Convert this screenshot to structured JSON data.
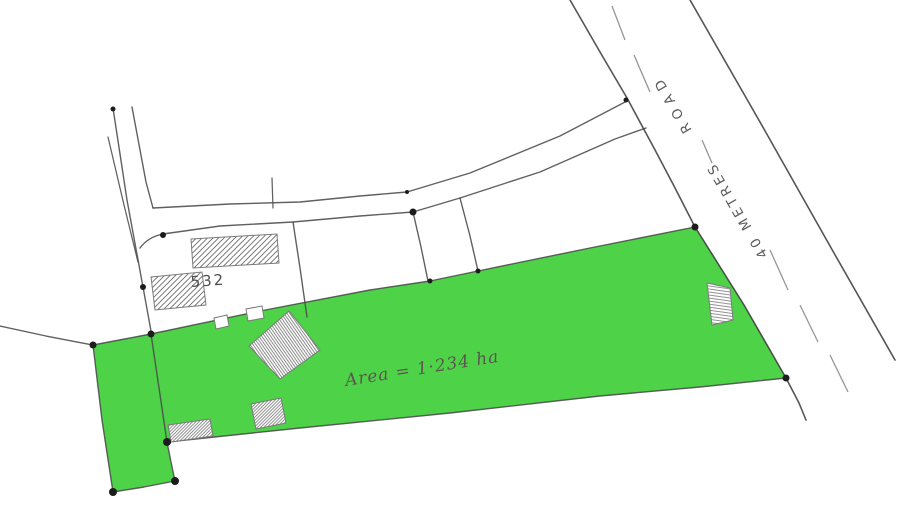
{
  "plan": {
    "road_label": {
      "full": "40 METRES ROAD",
      "line1": "40 METRES",
      "line2": "ROAD"
    },
    "parcel_number": "532",
    "area_note": "Area = 1·234 ha",
    "colors": {
      "highlight": "#4ed348",
      "pencil": "#4a4a4a",
      "paper": "#ffffff"
    }
  }
}
